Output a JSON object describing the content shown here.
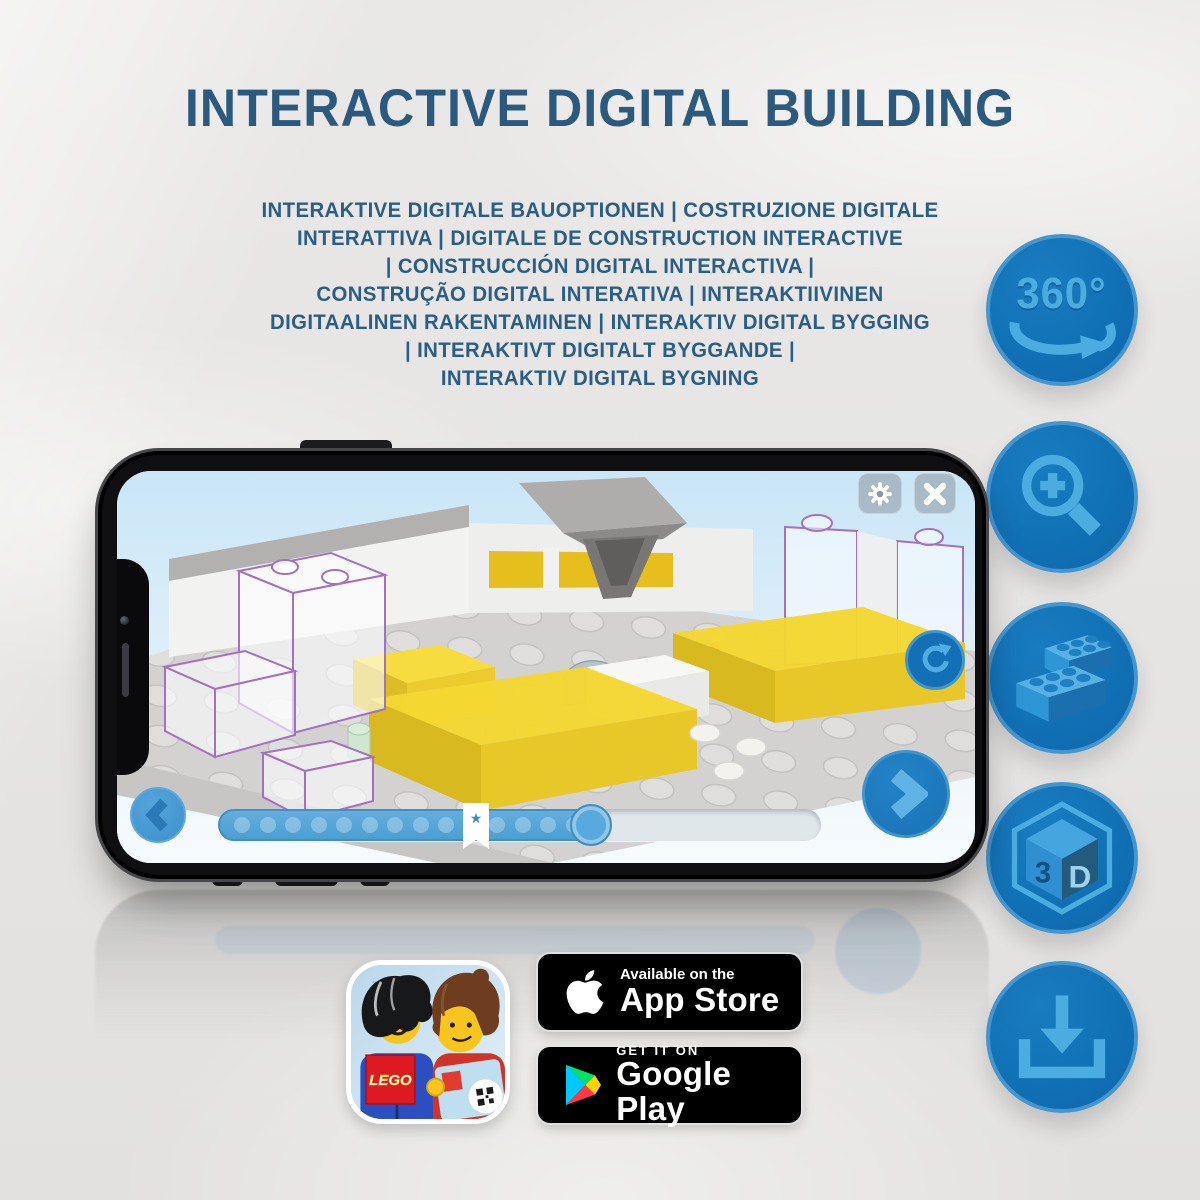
{
  "title": "INTERACTIVE DIGITAL BUILDING",
  "subtitle_lines": [
    "INTERAKTIVE DIGITALE BAUOPTIONEN | COSTRUZIONE DIGITALE",
    "INTERATTIVA | DIGITALE DE CONSTRUCTION INTERACTIVE",
    "| CONSTRUCCIÓN DIGITAL INTERACTIVA |",
    "CONSTRUÇÃO DIGITAL INTERATIVA | INTERAKTIIVINEN",
    "DIGITAALINEN RAKENTAMINEN | INTERAKTIV DIGITAL BYGGING",
    "| INTERAKTIVT DIGITALT BYGGANDE |",
    "INTERAKTIV DIGITAL BYGNING"
  ],
  "feature_badges": {
    "rotate_label": "360°",
    "cube_left": "3",
    "cube_right": "D"
  },
  "store": {
    "lego_logo": "LEGO",
    "app_store": {
      "tagline": "Available on the",
      "name": "App Store"
    },
    "google_play": {
      "tagline": "GET IT ON",
      "name": "Google Play"
    }
  },
  "colors": {
    "title_text": "#2c5a7f",
    "feature_circle": "#1171b5",
    "feature_glyph": "#4bacdf",
    "app_accent_blue": "#1b78bd",
    "brick_yellow": "#f2d32c",
    "ghost_outline": "#a271c2",
    "background": "#e6e5e3"
  }
}
